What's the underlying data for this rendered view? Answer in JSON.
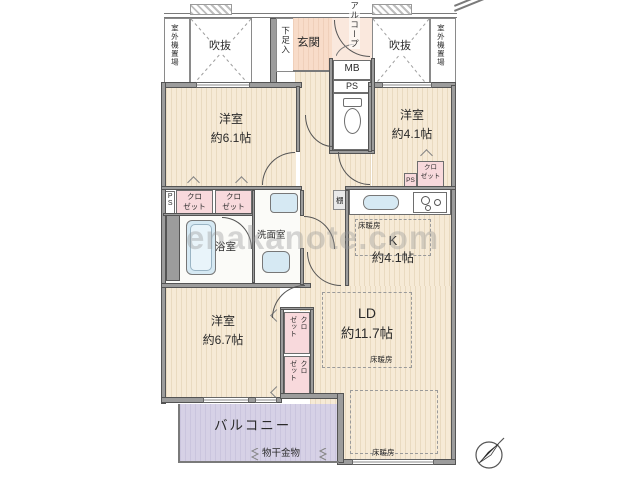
{
  "watermark": "enakanote.com",
  "exterior": {
    "outdoor_unit": "室外機置場",
    "void_label": "吹抜",
    "alcove": "アルコープ",
    "balcony": "バルコニー",
    "laundry_fitting": "物干金物"
  },
  "entrance": {
    "genkan": "玄関",
    "shoe_cabinet": "下足入",
    "meter_box": "MB",
    "pipe_space": "PS"
  },
  "rooms": {
    "bedroom1": {
      "name": "洋室",
      "size": "約6.1帖"
    },
    "bedroom2": {
      "name": "洋室",
      "size": "約4.1帖"
    },
    "bedroom3": {
      "name": "洋室",
      "size": "約6.7帖"
    },
    "kitchen": {
      "name": "K",
      "size": "約4.1帖"
    },
    "living": {
      "name": "LD",
      "size": "約11.7帖"
    },
    "bathroom": "浴室",
    "washroom": "洗面室"
  },
  "fixtures": {
    "closet": "クロ\nゼット",
    "pipe_space": "PS",
    "shelf": "棚",
    "floor_heating": "床暖房"
  },
  "colors": {
    "room_cream": "#f6ead6",
    "closet_pink": "#f8d9dc",
    "fixture_blue": "#d6e9f3",
    "entrance_peach": "#f8dcc9",
    "balcony_lavender": "#d6d1e6",
    "wall_gray": "#9c9c9c"
  }
}
